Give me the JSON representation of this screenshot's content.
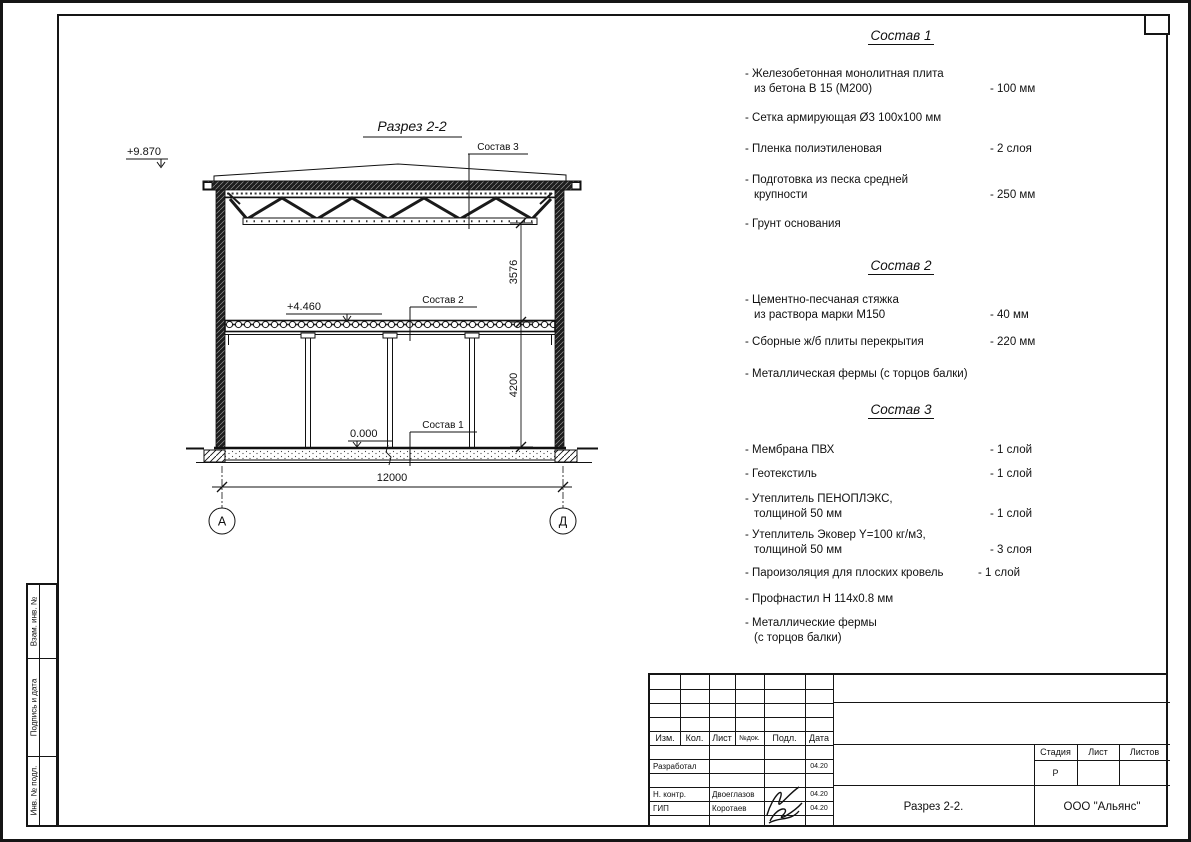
{
  "drawing": {
    "title": "Разрез 2-2",
    "elevation_roof": "+9.870",
    "elevation_floor": "+4.460",
    "elevation_zero": "0.000",
    "leader_sostav3": "Состав 3",
    "leader_sostav2": "Состав 2",
    "leader_sostav1": "Состав 1",
    "dim_truss": "3576",
    "dim_floor": "4200",
    "dim_span": "12000",
    "axis_left": "А",
    "axis_right": "Д"
  },
  "compositions": [
    {
      "heading": "Состав 1",
      "items": [
        {
          "line1": "- Железобетонная  монолитная плита",
          "line2": "из бетона В 15 (М200)",
          "value": "- 100 мм"
        },
        {
          "line1": "- Сетка армирующая Ø3 100x100 мм",
          "line2": "",
          "value": ""
        },
        {
          "line1": "- Пленка полиэтиленовая",
          "line2": "",
          "value": "- 2 слоя"
        },
        {
          "line1": "- Подготовка из песка средней",
          "line2": "крупности",
          "value": "- 250 мм"
        },
        {
          "line1": "- Грунт основания",
          "line2": "",
          "value": ""
        }
      ]
    },
    {
      "heading": "Состав 2",
      "items": [
        {
          "line1": "- Цементно-песчаная стяжка",
          "line2": "из раствора марки М150",
          "value": "- 40 мм"
        },
        {
          "line1": "- Сборные ж/б плиты перекрытия",
          "line2": "",
          "value": "- 220 мм"
        },
        {
          "line1": "- Металлическая фермы (с торцов балки)",
          "line2": "",
          "value": ""
        }
      ]
    },
    {
      "heading": "Состав 3",
      "items": [
        {
          "line1": "- Мембрана ПВХ",
          "line2": "",
          "value": "- 1 слой"
        },
        {
          "line1": "- Геотекстиль",
          "line2": "",
          "value": "- 1 слой"
        },
        {
          "line1": "- Утеплитель ПЕНОПЛЭКС,",
          "line2": "толщиной 50 мм",
          "value": "- 1 слой"
        },
        {
          "line1": "- Утеплитель Эковер Y=100 кг/м3,",
          "line2": "толщиной 50 мм",
          "value": "- 3 слоя"
        },
        {
          "line1": "- Пароизоляция для плоских кровель",
          "line2": "",
          "value": "- 1 слой"
        },
        {
          "line1": "- Профнастил Н 114x0.8 мм",
          "line2": "",
          "value": ""
        },
        {
          "line1": "- Металлические фермы",
          "line2": "(с торцов балки)",
          "value": ""
        }
      ]
    }
  ],
  "titleblock": {
    "header": {
      "izm": "Изм.",
      "kol": "Кол.",
      "list": "Лист",
      "ndok": "№док.",
      "podp": "Подл.",
      "data": "Дата"
    },
    "roles": {
      "razrabotal": "Разработал",
      "nkontr": "Н. контр.",
      "gip": "ГИП"
    },
    "names": {
      "nkontr": "Двоеглазов",
      "gip": "Коротаев"
    },
    "dates": {
      "razrabotal": "04.20",
      "nkontr": "04.20",
      "gip": "04.20"
    },
    "stage": {
      "stadia": "Стадия",
      "list": "Лист",
      "listov": "Листов",
      "stadia_value": "Р"
    },
    "doc_title": "Разрез 2-2.",
    "company": "ООО \"Альянс\""
  },
  "side_strip": {
    "cell1": "Взам. инв. №",
    "cell2": "Подпись и дата",
    "cell3": "Инв. № подл."
  }
}
